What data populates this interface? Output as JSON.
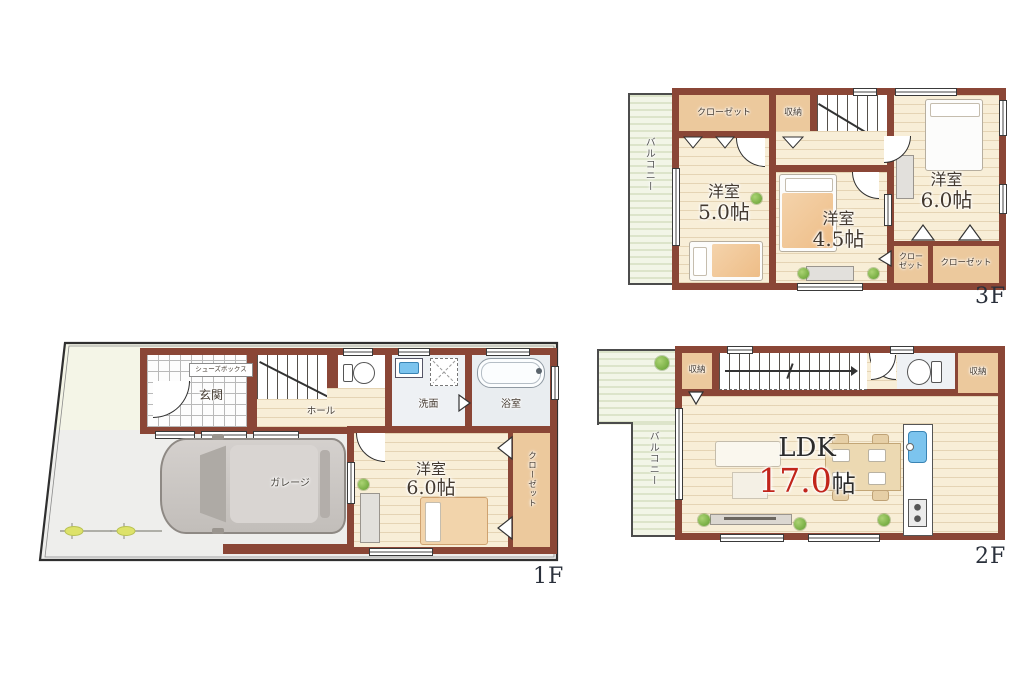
{
  "colors": {
    "wall": "#8a4636",
    "closet_fill": "#ecc99d",
    "wood_floor": "#f8eed7",
    "balcony_floor": "#f2f5e7",
    "accent_red": "#c1251b",
    "label_dark": "#43392f",
    "floor_label": "#2a303b",
    "water_blue": "#7cc4ee"
  },
  "floor3": {
    "floor_label": "3F",
    "balcony": "バルコニー",
    "closet_top": "クローゼット",
    "storage": "収納",
    "room5_name": "洋室",
    "room5_size": "5.0帖",
    "room45_name": "洋室",
    "room45_size": "4.5帖",
    "room6_name": "洋室",
    "room6_size": "6.0帖",
    "closet_small_line1": "クロー",
    "closet_small_line2": "ゼット",
    "closet_br": "クローゼット"
  },
  "floor2": {
    "floor_label": "2F",
    "balcony": "バルコニー",
    "storage_left": "収納",
    "storage_right": "収納",
    "ldk_name": "LDK",
    "ldk_size": "17.0",
    "ldk_unit": "帖"
  },
  "floor1": {
    "floor_label": "1F",
    "shoes_box": "シューズボックス",
    "entrance": "玄関",
    "hall": "ホール",
    "washroom": "洗面",
    "bathroom": "浴室",
    "garage": "ガレージ",
    "room6_name": "洋室",
    "room6_size": "6.0帖",
    "closet": "クローゼット"
  }
}
